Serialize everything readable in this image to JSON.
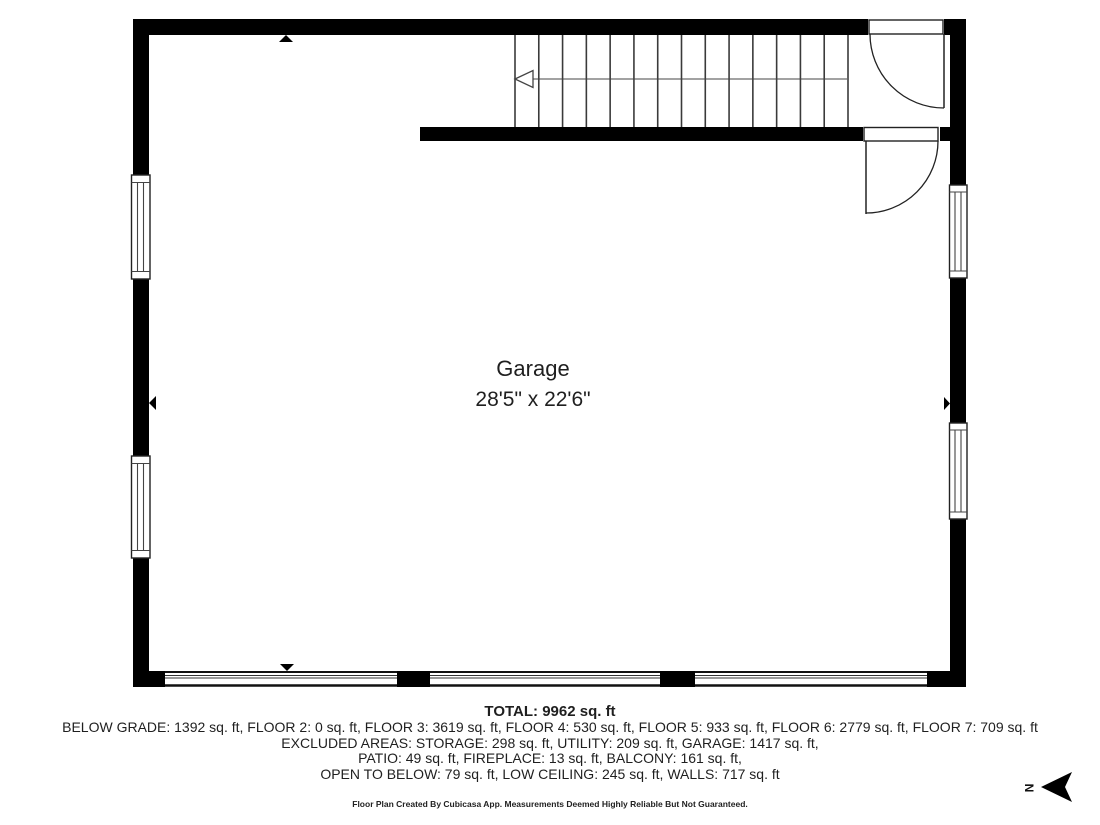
{
  "room": {
    "name": "Garage",
    "dimensions": "28'5\" x 22'6\""
  },
  "summary": {
    "total": "TOTAL: 9962 sq. ft",
    "lines": [
      "BELOW GRADE: 1392 sq. ft, FLOOR 2: 0 sq. ft, FLOOR 3: 3619 sq. ft, FLOOR 4: 530 sq. ft, FLOOR 5: 933 sq. ft, FLOOR 6: 2779 sq. ft, FLOOR 7: 709 sq. ft",
      "EXCLUDED AREAS: STORAGE: 298 sq. ft, UTILITY: 209 sq. ft, GARAGE: 1417 sq. ft,",
      "PATIO: 49 sq. ft, FIREPLACE: 13 sq. ft, BALCONY: 161 sq. ft,",
      "OPEN TO BELOW: 79 sq. ft, LOW CEILING: 245 sq. ft, WALLS: 717 sq. ft"
    ],
    "disclaimer": "Floor Plan Created By Cubicasa App. Measurements Deemed Highly Reliable But Not Guaranteed."
  },
  "compass": {
    "label": "N"
  },
  "icons": [
    "stair-direction-arrow-icon",
    "door-swing-icon",
    "window-icon",
    "garage-door-icon",
    "wall-marker-icon",
    "north-compass-icon"
  ],
  "colors": {
    "wall": "#000000",
    "line": "#3a3a3a",
    "background": "#ffffff",
    "text": "#1f1f1f"
  }
}
